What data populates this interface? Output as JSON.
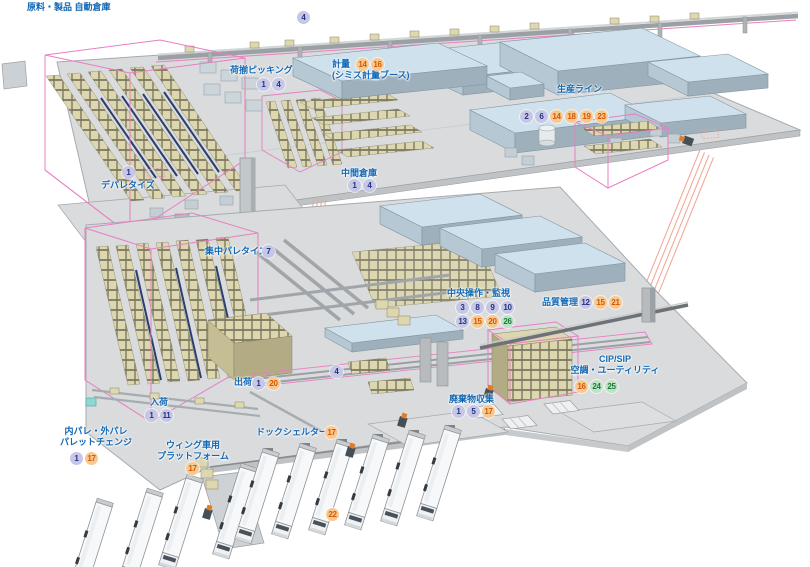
{
  "colors": {
    "label_blue": "#1368b4",
    "badge_blue_bg": "#c6c7e6",
    "badge_blue_text": "#253380",
    "badge_orange_bg": "#f8c98f",
    "badge_orange_text": "#d35708",
    "badge_green_bg": "#bfe2c6",
    "badge_green_text": "#197a38",
    "wireframe_pink": "#e87fc2",
    "projection_salmon": "#f2a492",
    "floor_gray": "#d9dbdd",
    "room_blue_top": "#cfe1ec",
    "rack_tan": "#ddd7af"
  },
  "labels": [
    {
      "name": "raw-product-auto-warehouse",
      "text": {
        "x": 27,
        "y": 2,
        "lines": [
          "原料・製品 自動倉庫"
        ]
      }
    },
    {
      "name": "overhead-conveyor",
      "badge_rows": [
        {
          "x": 297,
          "y": 11,
          "items": [
            {
              "n": "4",
              "c": "blue"
            }
          ]
        }
      ]
    },
    {
      "name": "load-picking",
      "text": {
        "x": 230,
        "y": 65,
        "lines": [
          "荷揃ピッキング"
        ]
      },
      "badge_rows": [
        {
          "x": 257,
          "y": 78,
          "items": [
            {
              "n": "1",
              "c": "blue"
            },
            {
              "n": "4",
              "c": "blue"
            }
          ]
        }
      ]
    },
    {
      "name": "weighing",
      "text": {
        "x": 332,
        "y": 59,
        "lines": [
          "計量",
          "(シミズ計量ブース)"
        ]
      },
      "badge_rows": [
        {
          "x": 356,
          "y": 58,
          "items": [
            {
              "n": "14",
              "c": "orange"
            },
            {
              "n": "16",
              "c": "orange"
            }
          ]
        }
      ]
    },
    {
      "name": "production-line",
      "text": {
        "x": 557,
        "y": 84,
        "lines": [
          "生産ライン"
        ]
      },
      "badge_rows": [
        {
          "x": 520,
          "y": 110,
          "items": [
            {
              "n": "2",
              "c": "blue"
            },
            {
              "n": "6",
              "c": "blue"
            },
            {
              "n": "14",
              "c": "orange"
            },
            {
              "n": "18",
              "c": "orange"
            },
            {
              "n": "19",
              "c": "orange"
            },
            {
              "n": "23",
              "c": "orange"
            }
          ]
        }
      ]
    },
    {
      "name": "intermediate-warehouse",
      "text": {
        "x": 341,
        "y": 168,
        "lines": [
          "中間倉庫"
        ]
      },
      "badge_rows": [
        {
          "x": 348,
          "y": 179,
          "items": [
            {
              "n": "1",
              "c": "blue"
            },
            {
              "n": "4",
              "c": "blue"
            }
          ]
        }
      ]
    },
    {
      "name": "depalletize",
      "text": {
        "x": 101,
        "y": 180,
        "lines": [
          "デパレタイズ"
        ]
      },
      "badge_rows": [
        {
          "x": 122,
          "y": 166,
          "items": [
            {
              "n": "1",
              "c": "blue"
            }
          ]
        }
      ]
    },
    {
      "name": "central-palletize",
      "text": {
        "x": 205,
        "y": 246,
        "lines": [
          "集中パレタイズ"
        ]
      },
      "badge_rows": [
        {
          "x": 262,
          "y": 245,
          "items": [
            {
              "n": "7",
              "c": "blue"
            }
          ]
        }
      ]
    },
    {
      "name": "central-operation-monitoring",
      "text": {
        "x": 447,
        "y": 288,
        "lines": [
          "中央操作・監視"
        ]
      },
      "badge_rows": [
        {
          "x": 456,
          "y": 301,
          "items": [
            {
              "n": "3",
              "c": "blue"
            },
            {
              "n": "8",
              "c": "blue"
            },
            {
              "n": "9",
              "c": "blue"
            },
            {
              "n": "10",
              "c": "blue"
            }
          ]
        },
        {
          "x": 456,
          "y": 315,
          "items": [
            {
              "n": "13",
              "c": "blue"
            },
            {
              "n": "15",
              "c": "orange"
            },
            {
              "n": "20",
              "c": "orange"
            },
            {
              "n": "26",
              "c": "green"
            }
          ]
        }
      ]
    },
    {
      "name": "quality-control",
      "text": {
        "x": 542,
        "y": 297,
        "lines": [
          "品質管理"
        ]
      },
      "badge_rows": [
        {
          "x": 579,
          "y": 296,
          "items": [
            {
              "n": "12",
              "c": "blue"
            },
            {
              "n": "15",
              "c": "orange"
            },
            {
              "n": "21",
              "c": "orange"
            }
          ]
        }
      ]
    },
    {
      "name": "cip-sip-utility",
      "text": {
        "x": 570,
        "y": 354,
        "w": 90,
        "align": "center",
        "lines": [
          "CIP/SIP",
          "空調・ユーティリティ"
        ]
      },
      "badge_rows": [
        {
          "x": 575,
          "y": 380,
          "items": [
            {
              "n": "16",
              "c": "orange"
            },
            {
              "n": "24",
              "c": "green"
            },
            {
              "n": "25",
              "c": "green"
            }
          ]
        }
      ]
    },
    {
      "name": "shipping",
      "text": {
        "x": 234,
        "y": 377,
        "lines": [
          "出荷"
        ]
      },
      "badge_rows": [
        {
          "x": 252,
          "y": 377,
          "items": [
            {
              "n": "1",
              "c": "blue"
            },
            {
              "n": "20",
              "c": "orange"
            }
          ]
        }
      ]
    },
    {
      "name": "lower-conveyor",
      "badge_rows": [
        {
          "x": 330,
          "y": 365,
          "items": [
            {
              "n": "4",
              "c": "blue"
            }
          ]
        }
      ]
    },
    {
      "name": "receiving",
      "text": {
        "x": 150,
        "y": 397,
        "lines": [
          "入荷"
        ]
      },
      "badge_rows": [
        {
          "x": 145,
          "y": 409,
          "items": [
            {
              "n": "1",
              "c": "blue"
            },
            {
              "n": "11",
              "c": "blue"
            }
          ]
        }
      ]
    },
    {
      "name": "waste-collection",
      "text": {
        "x": 449,
        "y": 394,
        "lines": [
          "廃棄物収集"
        ]
      },
      "badge_rows": [
        {
          "x": 452,
          "y": 405,
          "items": [
            {
              "n": "1",
              "c": "blue"
            },
            {
              "n": "5",
              "c": "blue"
            },
            {
              "n": "17",
              "c": "orange"
            }
          ]
        }
      ]
    },
    {
      "name": "pallet-change",
      "text": {
        "x": 58,
        "y": 426,
        "w": 76,
        "align": "center",
        "lines": [
          "内パレ・外パレ",
          "パレットチェンジ"
        ]
      },
      "badge_rows": [
        {
          "x": 70,
          "y": 452,
          "items": [
            {
              "n": "1",
              "c": "blue"
            },
            {
              "n": "17",
              "c": "orange"
            }
          ]
        }
      ]
    },
    {
      "name": "wing-truck-platform",
      "text": {
        "x": 155,
        "y": 440,
        "w": 76,
        "align": "center",
        "lines": [
          "ウィング車用",
          "プラットフォーム"
        ]
      },
      "badge_rows": [
        {
          "x": 186,
          "y": 462,
          "items": [
            {
              "n": "17",
              "c": "orange"
            }
          ]
        }
      ]
    },
    {
      "name": "dock-shelter",
      "text": {
        "x": 256,
        "y": 427,
        "lines": [
          "ドックシェルター"
        ]
      },
      "badge_rows": [
        {
          "x": 325,
          "y": 426,
          "items": [
            {
              "n": "17",
              "c": "orange"
            }
          ]
        }
      ]
    },
    {
      "name": "truck-yard",
      "badge_rows": [
        {
          "x": 326,
          "y": 508,
          "items": [
            {
              "n": "22",
              "c": "orange"
            }
          ]
        }
      ]
    }
  ]
}
